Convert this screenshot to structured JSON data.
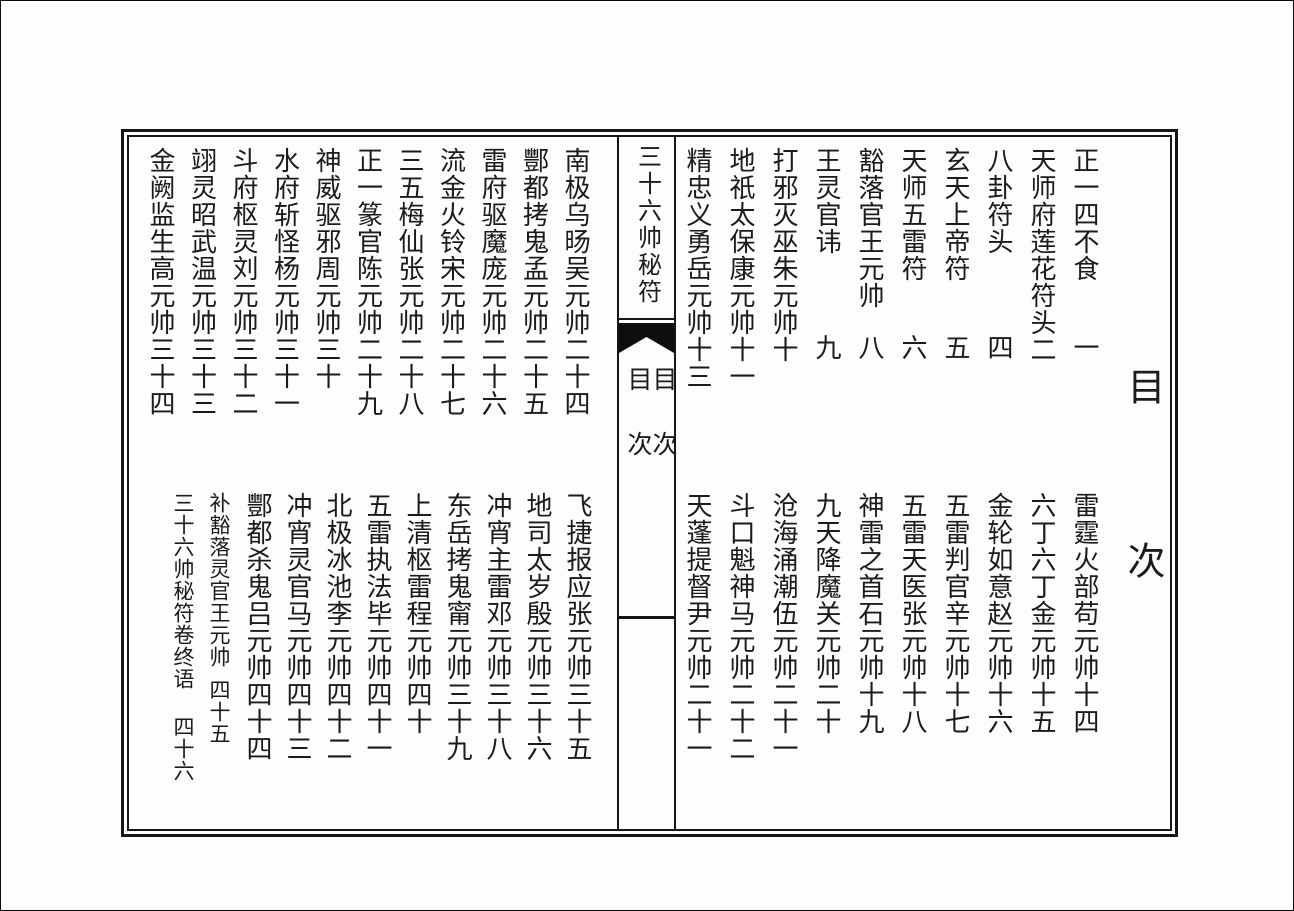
{
  "spine": {
    "book_title": "三十六帅秘符",
    "section_label": {
      "char1": "目",
      "char2": "次"
    }
  },
  "right_page": {
    "title_char1": "目",
    "title_char2": "次",
    "upper": [
      {
        "title": "正一四不食",
        "page": "一"
      },
      {
        "title": "天师府莲花符头",
        "page": "二"
      },
      {
        "title": "八卦符头",
        "page": "四"
      },
      {
        "title": "玄天上帝符",
        "page": "五"
      },
      {
        "title": "天师五雷符",
        "page": "六"
      },
      {
        "title": "豁落官王元帅",
        "page": "八"
      },
      {
        "title": "王灵官讳",
        "page": "九"
      },
      {
        "title": "打邪灭巫朱元帅",
        "page": "十"
      },
      {
        "title": "地祇太保康元帅",
        "page": "十一"
      },
      {
        "title": "精忠义勇岳元帅",
        "page": "十三"
      }
    ],
    "lower": [
      {
        "title": "雷霆火部苟元帅",
        "page": "十四"
      },
      {
        "title": "六丁六丁金元帅",
        "page": "十五"
      },
      {
        "title": "金轮如意赵元帅",
        "page": "十六"
      },
      {
        "title": "五雷判官辛元帅",
        "page": "十七"
      },
      {
        "title": "五雷天医张元帅",
        "page": "十八"
      },
      {
        "title": "神雷之首石元帅",
        "page": "十九"
      },
      {
        "title": "九天降魔关元帅",
        "page": "二十"
      },
      {
        "title": "沧海涌潮伍元帅",
        "page": "二十一"
      },
      {
        "title": "斗口魁神马元帅",
        "page": "二十二"
      },
      {
        "title": "天蓬提督尹元帅",
        "page": "二十一"
      }
    ]
  },
  "left_page": {
    "upper": [
      {
        "title": "南极乌旸吴元帅",
        "page": "二十四"
      },
      {
        "title": "酆都拷鬼孟元帅",
        "page": "二十五"
      },
      {
        "title": "雷府驱魔庞元帅",
        "page": "二十六"
      },
      {
        "title": "流金火铃宋元帅",
        "page": "二十七"
      },
      {
        "title": "三五梅仙张元帅",
        "page": "二十八"
      },
      {
        "title": "正一篆官陈元帅",
        "page": "二十九"
      },
      {
        "title": "神威驱邪周元帅",
        "page": "三十"
      },
      {
        "title": "水府斩怪杨元帅",
        "page": "三十一"
      },
      {
        "title": "斗府枢灵刘元帅",
        "page": "三十二"
      },
      {
        "title": "翊灵昭武温元帅",
        "page": "三十三"
      },
      {
        "title": "金阙监生高元帅",
        "page": "三十四"
      }
    ],
    "lower": [
      {
        "title": "飞捷报应张元帅",
        "page": "三十五"
      },
      {
        "title": "地司太岁殷元帅",
        "page": "三十六"
      },
      {
        "title": "冲宵主雷邓元帅",
        "page": "三十八"
      },
      {
        "title": "东岳拷鬼甯元帅",
        "page": "三十九"
      },
      {
        "title": "上清枢雷程元帅",
        "page": "四十"
      },
      {
        "title": "五雷执法毕元帅",
        "page": "四十一"
      },
      {
        "title": "北极冰池李元帅",
        "page": "四十二"
      },
      {
        "title": "冲宵灵官马元帅",
        "page": "四十三"
      },
      {
        "title": "酆都杀鬼吕元帅",
        "page": "四十四"
      },
      {
        "title": "补豁落灵官王元帅",
        "page": "四十五"
      },
      {
        "title": "三十六帅秘符卷终语",
        "page": "四十六"
      }
    ]
  }
}
